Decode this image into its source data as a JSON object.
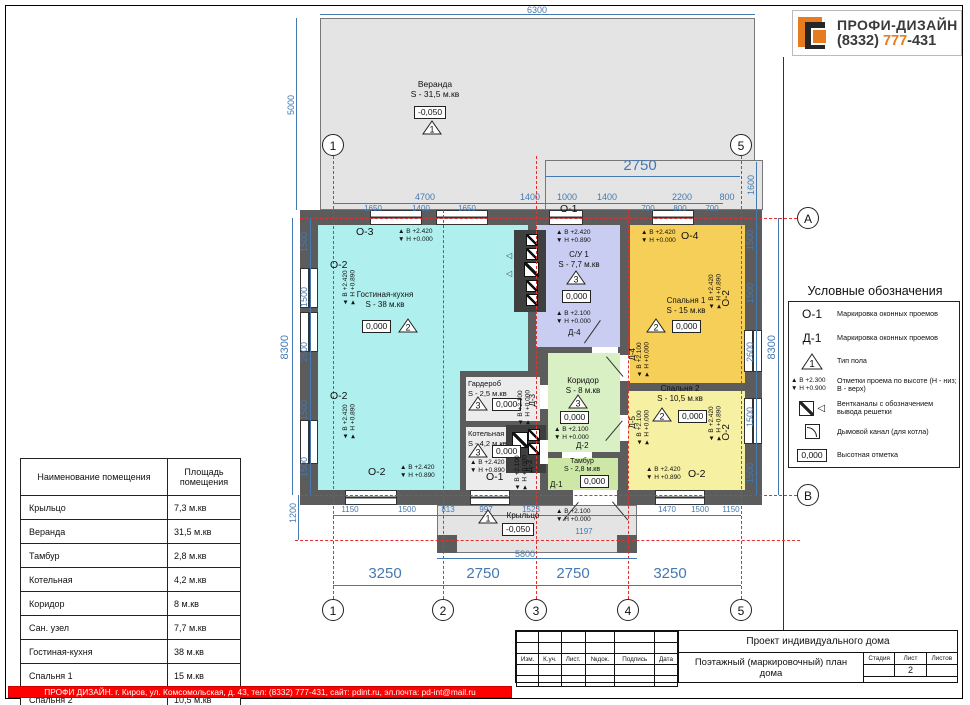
{
  "logo": {
    "brand": "ПРОФИ-ДИЗАЙН",
    "phone_area": "(8332) ",
    "phone_num": "777",
    "phone_tail": "-431"
  },
  "footer": {
    "text": "ПРОФИ ДИЗАЙН. г. Киров, ул. Комсомольская, д. 43, тел: (8332) 777-431, сайт: pdint.ru, эл.почта: pd-int@mail.ru"
  },
  "room_table": {
    "headers": [
      "Наименование помещения",
      "Площадь помещения"
    ],
    "rows": [
      [
        "Крыльцо",
        "7,3 м.кв"
      ],
      [
        "Веранда",
        "31,5 м.кв"
      ],
      [
        "Тамбур",
        "2,8 м.кв"
      ],
      [
        "Котельная",
        "4,2 м.кв"
      ],
      [
        "Коридор",
        "8 м.кв"
      ],
      [
        "Сан. узел",
        "7,7 м.кв"
      ],
      [
        "Гостиная-кухня",
        "38 м.кв"
      ],
      [
        "Спальня 1",
        "15 м.кв"
      ],
      [
        "Спальня 2",
        "10,5 м.кв"
      ]
    ]
  },
  "legend": {
    "title": "Условные обозначения",
    "items": [
      {
        "symbol": "О-1",
        "text": "Маркировка оконных проемов"
      },
      {
        "symbol": "Д-1",
        "text": "Маркировка оконных проемов"
      },
      {
        "tri": "1",
        "text": "Тип пола"
      },
      {
        "mark_b": "▲ В +2.300",
        "mark_h": "▼ Н +0.900",
        "text": "Отметки проема по высоте (Н - низ; В - верх)"
      },
      {
        "text": "Вентканалы с обозначением вывода решетки"
      },
      {
        "text": "Дымовой канал (для котла)"
      },
      {
        "symbol": "0,000",
        "text": "Высотная отметка"
      }
    ]
  },
  "title_block": {
    "project": "Проект индивидуального дома",
    "drawing": "Поэтажный (маркировочный) план дома",
    "cols": [
      "Изм.",
      "К.уч.",
      "Лист.",
      "№док.",
      "Подпись",
      "Дата"
    ],
    "right_cols": [
      "Стадия",
      "Лист",
      "Листов"
    ],
    "sheet": "2"
  },
  "plan": {
    "axes": {
      "a1": "1",
      "a2": "2",
      "a3": "3",
      "a4": "4",
      "a5": "5",
      "aA": "А",
      "aB": "В"
    },
    "marks": {
      "b2420": "▲ В +2.420",
      "b2100": "▲ В +2.100",
      "h0000": "▼ Н +0.000",
      "h0890": "▼ Н +0.890"
    },
    "windows": {
      "o1": "О-1",
      "o2": "О-2",
      "o3": "О-3",
      "o4": "О-4"
    },
    "doors": {
      "d1": "Д-1",
      "d2": "Д-2",
      "d3": "Д-3",
      "d4": "Д-4",
      "d5": "Д-5"
    },
    "elev": {
      "zero": "0,000",
      "minus": "-0,050"
    },
    "floors": {
      "f1": "1",
      "f2": "2",
      "f3": "3"
    },
    "rooms": {
      "veranda": {
        "name": "Веранда",
        "area": "S - 31,5 м.кв"
      },
      "living": {
        "name": "Гостиная-кухня",
        "area": "S - 38 м.кв"
      },
      "su1": {
        "name": "С/У 1",
        "area": "S - 7,7 м.кв"
      },
      "bed1": {
        "name": "Спальня 1",
        "area": "S - 15 м.кв"
      },
      "bed2": {
        "name": "Спальня 2",
        "area": "S - 10,5 м.кв"
      },
      "wardrobe": {
        "name": "Гардероб",
        "area": "S - 2,5 м.кв"
      },
      "boiler": {
        "name": "Котельная",
        "area": "S - 4,2 м.кв"
      },
      "corridor": {
        "name": "Коридор",
        "area": "S - 8 м.кв"
      },
      "tambur": {
        "name": "Тамбур",
        "area": "S - 2,8 м.кв"
      },
      "porch": {
        "name": "Крыльцо"
      }
    },
    "dims": {
      "veranda_w": "6300",
      "veranda_h": "5000",
      "top_big": "2750",
      "band_h": "1600",
      "top_row1": [
        "4700",
        "1400",
        "1000",
        "1400",
        "2200",
        "800"
      ],
      "top_row2": [
        "1650",
        "1400",
        "1650",
        "700",
        "800",
        "700"
      ],
      "left_segs": [
        "1500",
        "1500",
        "2600",
        "1500",
        "1500"
      ],
      "left_overall": "8300",
      "left_bottom": "1200",
      "right_segs": [
        "1500",
        "1500",
        "2600",
        "1500",
        "1500"
      ],
      "right_overall": "8300",
      "bottom_row": [
        "1150",
        "1500",
        "813",
        "997",
        "1523",
        "1470",
        "1500",
        "1150"
      ],
      "porch_w": "5800",
      "door_w": "1197",
      "axis_row": [
        "3250",
        "2750",
        "2750",
        "3250"
      ]
    }
  }
}
